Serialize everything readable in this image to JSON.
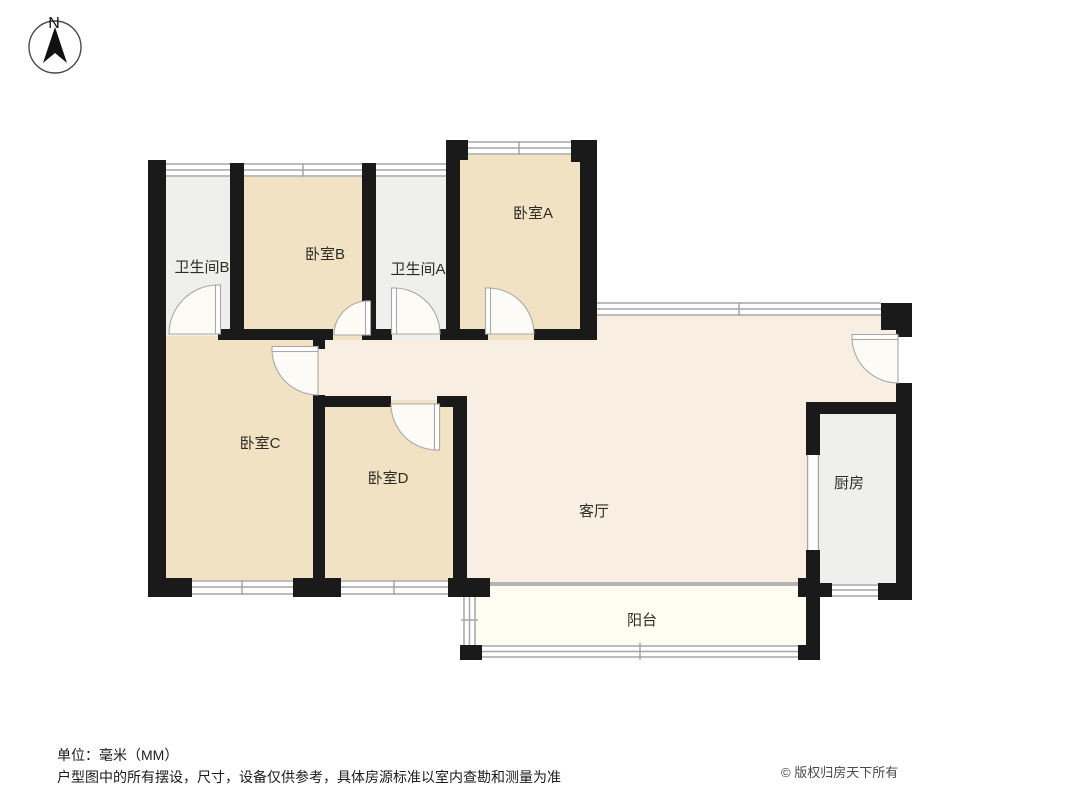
{
  "compass": {
    "north_label": "N"
  },
  "rooms": [
    {
      "id": "bedroom-a",
      "label": "卧室A"
    },
    {
      "id": "bedroom-b",
      "label": "卧室B"
    },
    {
      "id": "bedroom-c",
      "label": "卧室C"
    },
    {
      "id": "bedroom-d",
      "label": "卧室D"
    },
    {
      "id": "bathroom-a",
      "label": "卫生间A"
    },
    {
      "id": "bathroom-b",
      "label": "卫生间B"
    },
    {
      "id": "living-room",
      "label": "客厅"
    },
    {
      "id": "kitchen",
      "label": "厨房"
    },
    {
      "id": "balcony",
      "label": "阳台"
    }
  ],
  "footer": {
    "unit_note": "单位：毫米（MM）",
    "disclaimer": "户型图中的所有摆设，尺寸，设备仅供参考，具体房源标准以室内查勘和测量为准",
    "copyright": "© 版权归房天下所有"
  },
  "palette": {
    "wall": "#1a1a1a",
    "bedroom_fill": "#f1e2c3",
    "bathroom_fill": "#efefee",
    "living_fill": "#f8efe2",
    "balcony_fill": "#fffdf0",
    "window_line": "#a6a6a6",
    "background": "#ffffff"
  }
}
